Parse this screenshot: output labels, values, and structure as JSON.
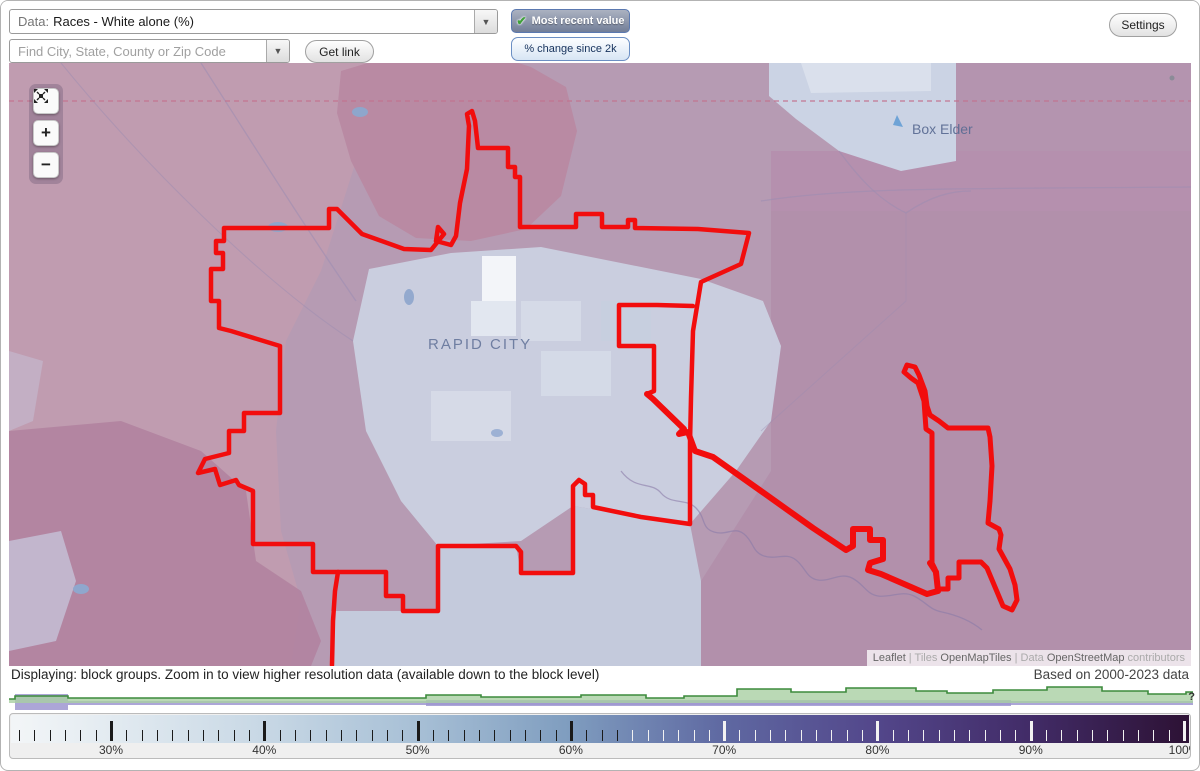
{
  "toolbar": {
    "data_prefix": "Data:",
    "data_value": "Races - White alone (%)",
    "data_arrow": "▼",
    "search_placeholder": "Find City, State, County or Zip Code",
    "search_arrow": "▼",
    "get_link": "Get link",
    "most_recent": "Most recent value",
    "most_recent_check": "✔",
    "pct_change": "% change since 2k",
    "settings": "Settings"
  },
  "map": {
    "city_label": "RAPID CITY",
    "place_label": "Box Elder",
    "controls": {
      "zoom_in": "+",
      "zoom_out": "−"
    },
    "attribution": [
      {
        "text": "Leaflet",
        "muted": false
      },
      {
        "text": " | ",
        "muted": true
      },
      {
        "text": "Tiles ",
        "muted": true
      },
      {
        "text": "OpenMapTiles",
        "muted": false
      },
      {
        "text": " | ",
        "muted": true
      },
      {
        "text": "Data ",
        "muted": true
      },
      {
        "text": "OpenStreetMap",
        "muted": false
      },
      {
        "text": " contributors",
        "muted": true
      }
    ]
  },
  "status": {
    "left": "Displaying: block groups. Zoom in to view higher resolution data (available down to the block level)",
    "right": "Based on 2000-2023 data"
  },
  "legend": {
    "help": "?",
    "min_pct": 24,
    "max_pct": 100,
    "tick_step": 1,
    "major_step": 10,
    "label_suffix": "%",
    "px_per_pct": 15.329,
    "x_at_30pct": 100,
    "dark_tick_max_pct": 63,
    "gradient_colors": [
      "#f2f5f7",
      "#e3ebf1",
      "#c8d8e5",
      "#a8c0d6",
      "#7f9dbf",
      "#5f69a2",
      "#53478b",
      "#422c68",
      "#2e1337"
    ],
    "gradient_positions": [
      0.5,
      8.3,
      21.3,
      34.3,
      47.3,
      60.3,
      73.3,
      86.3,
      99.2
    ]
  },
  "chart_data": {
    "type": "area",
    "title": "distribution of block groups across % white alone",
    "xlabel": "% white alone (aligned with legend scale 24%-100%)",
    "ylabel": "relative frequency",
    "series": [
      {
        "name": "current-distribution-green",
        "stroke": "#3d8b3d",
        "fill": "#a9cfa2",
        "baseline_y": 18,
        "points": [
          [
            0,
            14
          ],
          [
            6,
            14
          ],
          [
            6,
            11
          ],
          [
            59,
            11
          ],
          [
            59,
            13
          ],
          [
            417,
            13
          ],
          [
            417,
            10
          ],
          [
            472,
            10
          ],
          [
            472,
            12
          ],
          [
            572,
            12
          ],
          [
            572,
            10
          ],
          [
            637,
            10
          ],
          [
            637,
            13
          ],
          [
            675,
            13
          ],
          [
            675,
            11
          ],
          [
            728,
            11
          ],
          [
            728,
            4
          ],
          [
            782,
            4
          ],
          [
            782,
            7
          ],
          [
            837,
            7
          ],
          [
            837,
            3
          ],
          [
            907,
            3
          ],
          [
            907,
            6
          ],
          [
            938,
            6
          ],
          [
            938,
            8
          ],
          [
            984,
            8
          ],
          [
            984,
            5
          ],
          [
            1038,
            5
          ],
          [
            1038,
            2
          ],
          [
            1093,
            2
          ],
          [
            1093,
            6
          ],
          [
            1139,
            6
          ],
          [
            1139,
            9
          ],
          [
            1177,
            9
          ],
          [
            1177,
            7
          ],
          [
            1184,
            7
          ]
        ]
      },
      {
        "name": "comparison-distribution-purple",
        "fill": "#9d97d0",
        "blocks": [
          [
            6,
            9,
            53,
            16
          ],
          [
            59,
            16,
            1125,
            4
          ],
          [
            417,
            15,
            585,
            6
          ]
        ]
      }
    ]
  }
}
